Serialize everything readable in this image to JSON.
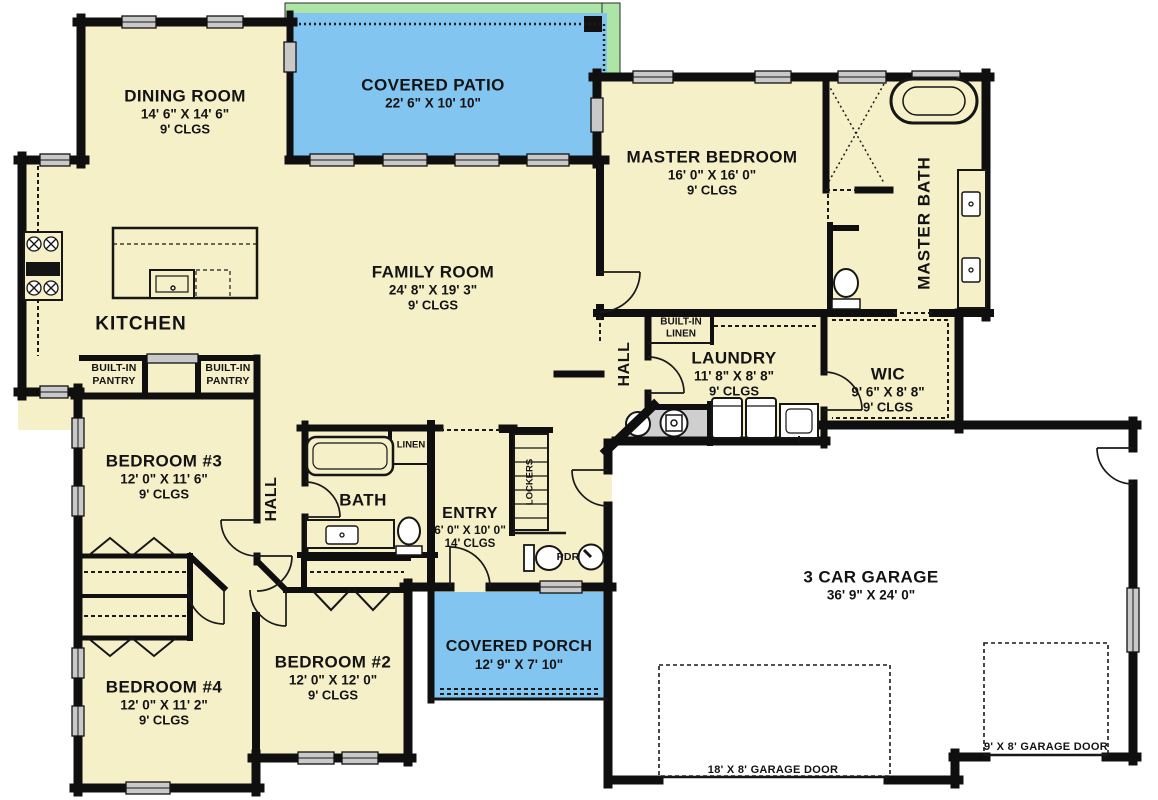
{
  "colors": {
    "floor": "#F5F0C8",
    "patio_blue": "#82C5F0",
    "porch_blue": "#82C5F0",
    "green_edge": "#ACE5A6",
    "wall": "#0F0F0F",
    "window_gray": "#C9C9C9",
    "mech_gray": "#CFCFCF",
    "garage_white": "#FFFFFF",
    "text": "#131313"
  },
  "rooms": {
    "dining": {
      "name": "DINING ROOM",
      "dims": "14' 6\" X 14' 6\"",
      "clgs": "9' CLGS"
    },
    "patio": {
      "name": "COVERED PATIO",
      "dims": "22' 6\" X 10' 10\""
    },
    "master_bedroom": {
      "name": "MASTER BEDROOM",
      "dims": "16' 0\" X 16' 0\"",
      "clgs": "9' CLGS"
    },
    "master_bath": {
      "name": "MASTER BATH"
    },
    "family": {
      "name": "FAMILY ROOM",
      "dims": "24' 8\" X 19' 3\"",
      "clgs": "9' CLGS"
    },
    "kitchen": {
      "name": "KITCHEN"
    },
    "pantry_left": {
      "line1": "BUILT-IN",
      "line2": "PANTRY"
    },
    "pantry_right": {
      "line1": "BUILT-IN",
      "line2": "PANTRY"
    },
    "hall_master": {
      "name": "HALL"
    },
    "built_in_linen": {
      "line1": "BUILT-IN",
      "line2": "LINEN"
    },
    "laundry": {
      "name": "LAUNDRY",
      "dims": "11' 8\" X 8' 8\"",
      "clgs": "9' CLGS"
    },
    "wic": {
      "name": "WIC",
      "dims": "9' 6\" X 8' 8\"",
      "clgs": "9' CLGS"
    },
    "bedroom3": {
      "name": "BEDROOM #3",
      "dims": "12' 0\" X 11' 6\"",
      "clgs": "9' CLGS"
    },
    "hall_bedroom": {
      "name": "HALL"
    },
    "bath": {
      "name": "BATH"
    },
    "linen": {
      "name": "LINEN"
    },
    "entry": {
      "name": "ENTRY",
      "dims": "6' 0\" X 10' 0\"",
      "clgs": "14' CLGS"
    },
    "lockers": {
      "name": "LOCKERS"
    },
    "pdr": {
      "name": "PDR"
    },
    "garage": {
      "name": "3 CAR GARAGE",
      "dims": "36' 9\" X 24' 0\""
    },
    "bedroom2": {
      "name": "BEDROOM #2",
      "dims": "12' 0\" X 12' 0\"",
      "clgs": "9' CLGS"
    },
    "porch": {
      "name": "COVERED PORCH",
      "dims": "12' 9\" X 7' 10\""
    },
    "bedroom4": {
      "name": "BEDROOM #4",
      "dims": "12' 0\" X 11' 2\"",
      "clgs": "9' CLGS"
    }
  },
  "garage_doors": {
    "large": "18' X 8' GARAGE DOOR",
    "small": "9' X 8' GARAGE DOOR"
  }
}
